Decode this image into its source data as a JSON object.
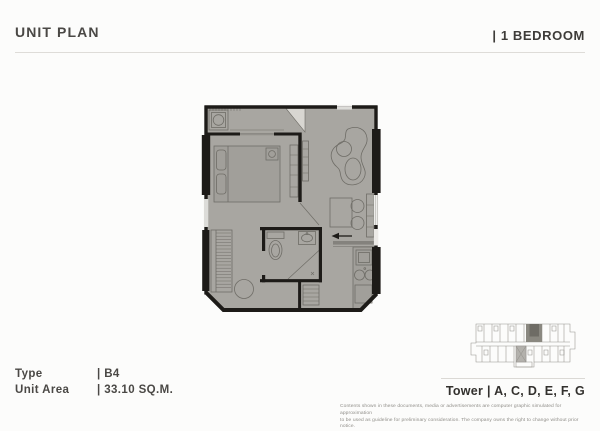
{
  "header": {
    "title": "UNIT PLAN",
    "category": "| 1 BEDROOM"
  },
  "info": {
    "rows": [
      {
        "label": "Type",
        "value": "| B4"
      },
      {
        "label": "Unit Area",
        "value": "| 33.10 SQ.M."
      }
    ]
  },
  "tower": {
    "text": "Tower | A, C, D, E, F, G"
  },
  "disclaimer": {
    "line1": "Contents  shown in these documents, media or advertisements are computer graphic simulated for approximation",
    "line2": "to be used as guideline for preliminary consideration. The company owns the right to change without prior notice."
  },
  "floor_plan": {
    "name": "unit-b4-floor-plan",
    "rooms": [
      "balcony",
      "bedroom",
      "living-dining",
      "bathroom",
      "kitchen",
      "wardrobe"
    ],
    "colors": {
      "floor": "#a8a6a1",
      "wall": "#1d1b18",
      "furniture_line": "#6f6d67",
      "window": "#f3f2f0"
    }
  },
  "key_plan": {
    "name": "tower-key-plan",
    "highlight_color": "#6e6c65"
  }
}
